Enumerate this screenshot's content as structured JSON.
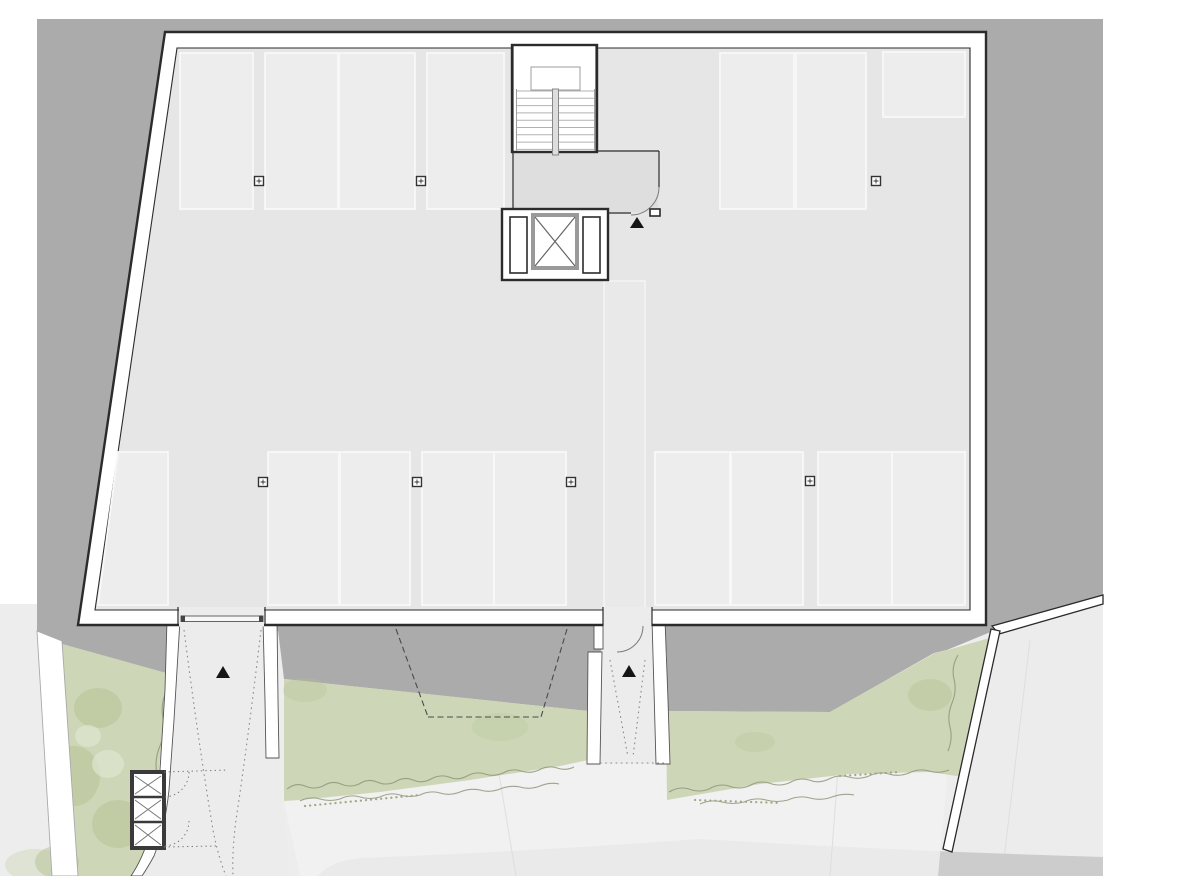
{
  "drawing": {
    "kind": "floor-plan",
    "visible_text": "",
    "entrance_marker_glyph": "▲"
  },
  "elements": {
    "parking_stalls_top_row": 7,
    "parking_stalls_bottom_row": 9,
    "structural_columns": 7,
    "entrance_markers": 3,
    "stair_cores": 1,
    "elevators": 1,
    "vehicle_gates": 1,
    "storage_boxes": 3
  },
  "colors": {
    "page": "#ffffff",
    "ground": "#ababab",
    "floor": "#e6e6e6",
    "stall": "#ededed",
    "walkway": "#eaeaea",
    "lobby": "#dedede",
    "wall": "#ffffff",
    "outline": "#2b2b2b",
    "green": "#cdd6b6",
    "green_canopy": "#b5c294",
    "green_light": "#e3e7d5",
    "hedge": "#8f957b",
    "path": "#ededed",
    "path_light": "#f1f1f1",
    "road": "#cccccc",
    "parcel": "#ececec",
    "marker": "#151515",
    "shaft_stroke": "#9a9a9a",
    "door_arc": "#7a7a7a",
    "structure_outline": "#3a3a3a"
  }
}
